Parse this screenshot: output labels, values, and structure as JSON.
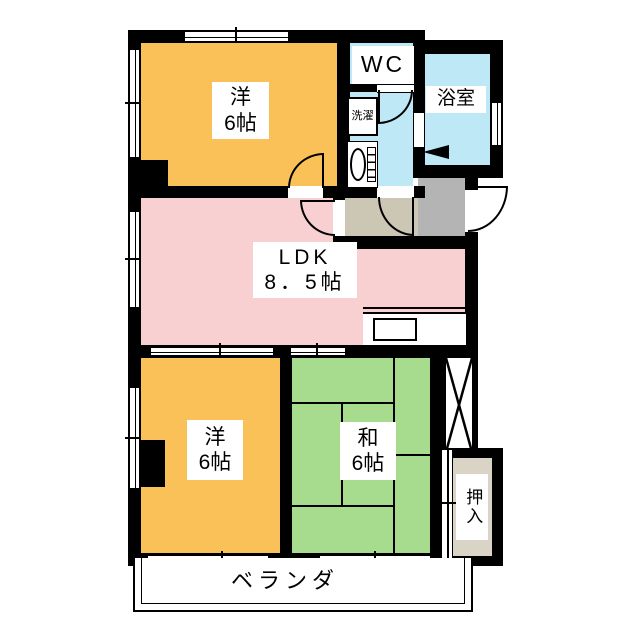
{
  "floorplan": {
    "rooms": {
      "western_top": {
        "name": "洋",
        "size": "6帖"
      },
      "western_bottom": {
        "name": "洋",
        "size": "6帖"
      },
      "japanese": {
        "name": "和",
        "size": "6帖"
      },
      "ldk": {
        "name": "LDK",
        "size": "8．5帖"
      },
      "wc": {
        "name": "WC"
      },
      "bathroom": {
        "name": "浴室"
      },
      "laundry": {
        "name": "洗濯"
      },
      "closet": {
        "name": "押入"
      },
      "veranda": {
        "name": "ベランダ"
      }
    },
    "colors": {
      "wall": "#000000",
      "western_room": "#F9C158",
      "ldk": "#F8D0D2",
      "japanese_room": "#A7DC8F",
      "wet_area": "#BEE8F6",
      "hallway": "#CCC6B4",
      "entry": "#B4B4B4",
      "closet_interior": "#D9D4C5"
    }
  }
}
